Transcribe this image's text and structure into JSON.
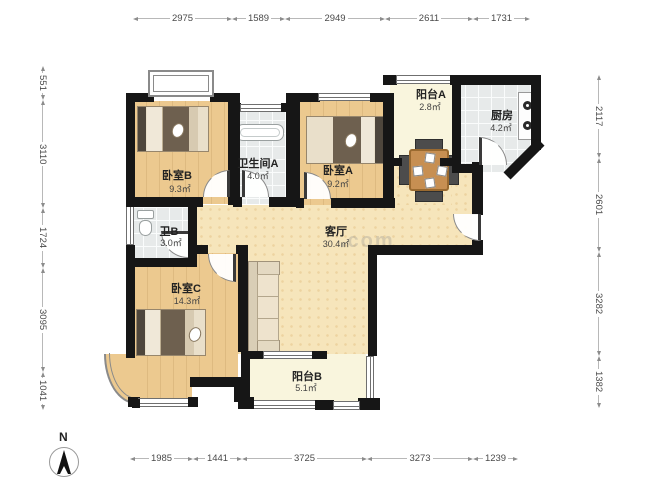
{
  "plan": {
    "rooms": {
      "bedroomB": {
        "name": "卧室B",
        "area": "9.3㎡"
      },
      "bathroomA": {
        "name": "卫生间A",
        "area": "4.0㎡"
      },
      "bedroomA": {
        "name": "卧室A",
        "area": "9.2㎡"
      },
      "balconyA": {
        "name": "阳台A",
        "area": "2.8㎡"
      },
      "kitchen": {
        "name": "厨房",
        "area": "4.2㎡"
      },
      "livingRoom": {
        "name": "客厅",
        "area": "30.4㎡"
      },
      "bathroomB": {
        "name": "卫B",
        "area": "3.0㎡"
      },
      "bedroomC": {
        "name": "卧室C",
        "area": "14.3㎡"
      },
      "balconyB": {
        "name": "阳台B",
        "area": "5.1㎡"
      }
    },
    "dims": {
      "top": [
        "2975",
        "1589",
        "2949",
        "2611",
        "1731"
      ],
      "bottom": [
        "1985",
        "1441",
        "3725",
        "3273",
        "1239"
      ],
      "left": [
        "551",
        "3110",
        "1724",
        "3095",
        "1041"
      ],
      "right": [
        "2117",
        "2601",
        "3282",
        "1382"
      ]
    },
    "compass": {
      "label": "N"
    },
    "watermark": ".com",
    "colors": {
      "wall": "#161616",
      "wood": "#ecc98f",
      "hall": "#f6e5bb",
      "tile": "#e7eaea",
      "balcony": "#f9f5dd"
    }
  }
}
